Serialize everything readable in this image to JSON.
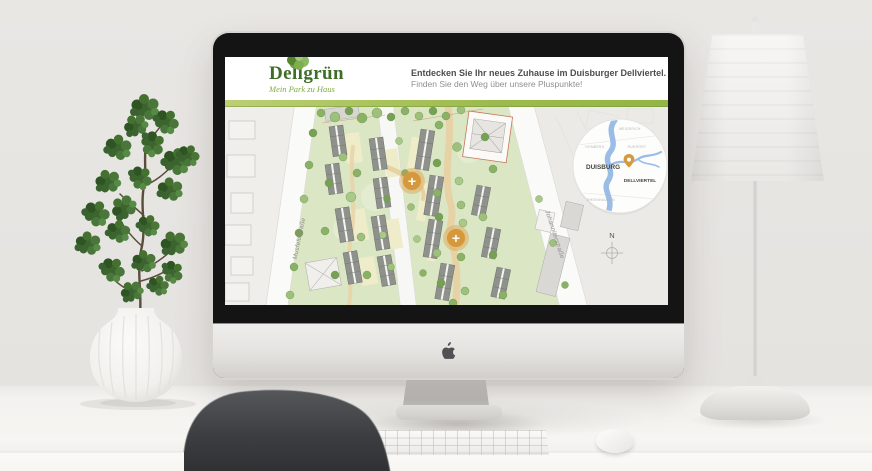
{
  "brand": {
    "logo_part1": "De",
    "logo_part2": "ll",
    "logo_part3": "grün",
    "tagline": "Mein Park zu Haus",
    "colors": {
      "logo_green": "#3e6e29",
      "tagline_green": "#82ad45",
      "stripe_green": "#9cbb4c",
      "plus_orange": "#d5983c",
      "minimap_river_blue": "#8fb6e4"
    }
  },
  "header": {
    "headline": "Entdecken Sie Ihr neues Zuhause im Duisburger Dellviertel.",
    "subheadline": "Finden Sie den Weg über unsere Pluspunkte!"
  },
  "map": {
    "streets": {
      "left": "Musfeldstraße",
      "right": "Johanniterstraße"
    },
    "plus_label": "+",
    "compass_label": "N",
    "minimap": {
      "city": "DUISBURG",
      "district": "DELLVIERTEL",
      "areas": [
        "MEIDERICH",
        "RUHRORT",
        "HOMBERG",
        "RHEINHAUSEN"
      ]
    }
  }
}
